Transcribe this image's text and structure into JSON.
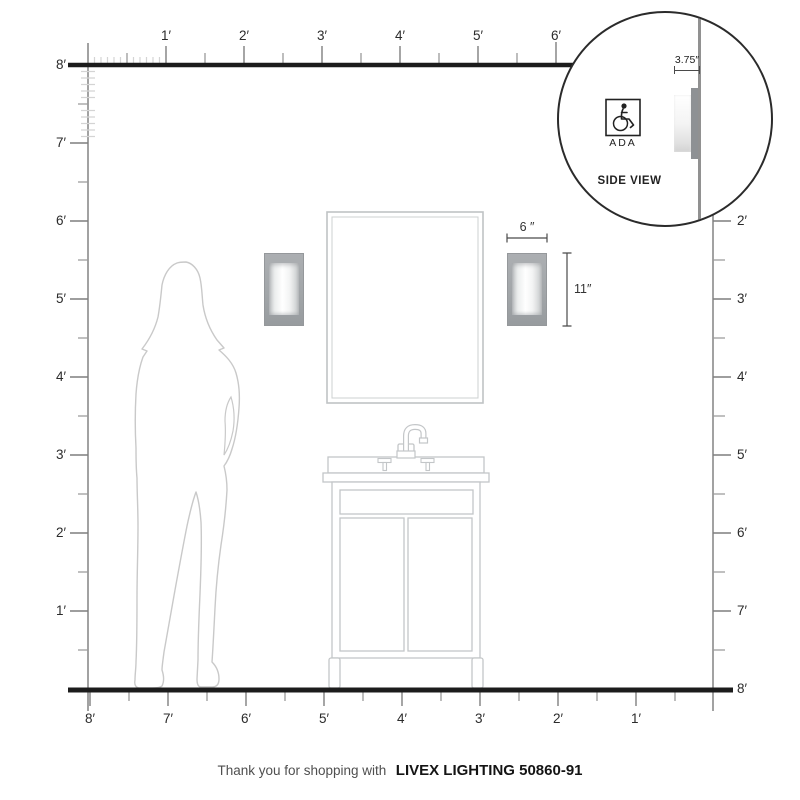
{
  "rulers": {
    "top": {
      "labels": [
        "1′",
        "2′",
        "3′",
        "4′",
        "5′",
        "6′"
      ]
    },
    "left": {
      "labels": [
        "8′",
        "7′",
        "6′",
        "5′",
        "4′",
        "3′",
        "2′",
        "1′"
      ]
    },
    "right": {
      "labels": [
        "2′",
        "3′",
        "4′",
        "5′",
        "6′",
        "7′",
        "8′"
      ]
    },
    "bottom": {
      "labels": [
        "8′",
        "7′",
        "6′",
        "5′",
        "4′",
        "3′",
        "2′",
        "1′"
      ]
    }
  },
  "fixture": {
    "width_label": "6 ″",
    "height_label": "11″",
    "depth_label": "3.75″"
  },
  "inset": {
    "title": "SIDE VIEW",
    "ada_label": "ADA"
  },
  "footer": {
    "prefix": "Thank you for shopping with",
    "product": "LIVEX LIGHTING 50860-91"
  },
  "colors": {
    "structure_line": "#1c1c1c",
    "ruler_line": "#8a8a8a",
    "tick": "#7f7f7f",
    "tick_light": "#d4d4d4",
    "outline_light": "#c3c6c8",
    "silhouette": "#c9c9c9",
    "sconce_plate": "#a2a6a9",
    "dim_line": "#4a4a4a"
  }
}
